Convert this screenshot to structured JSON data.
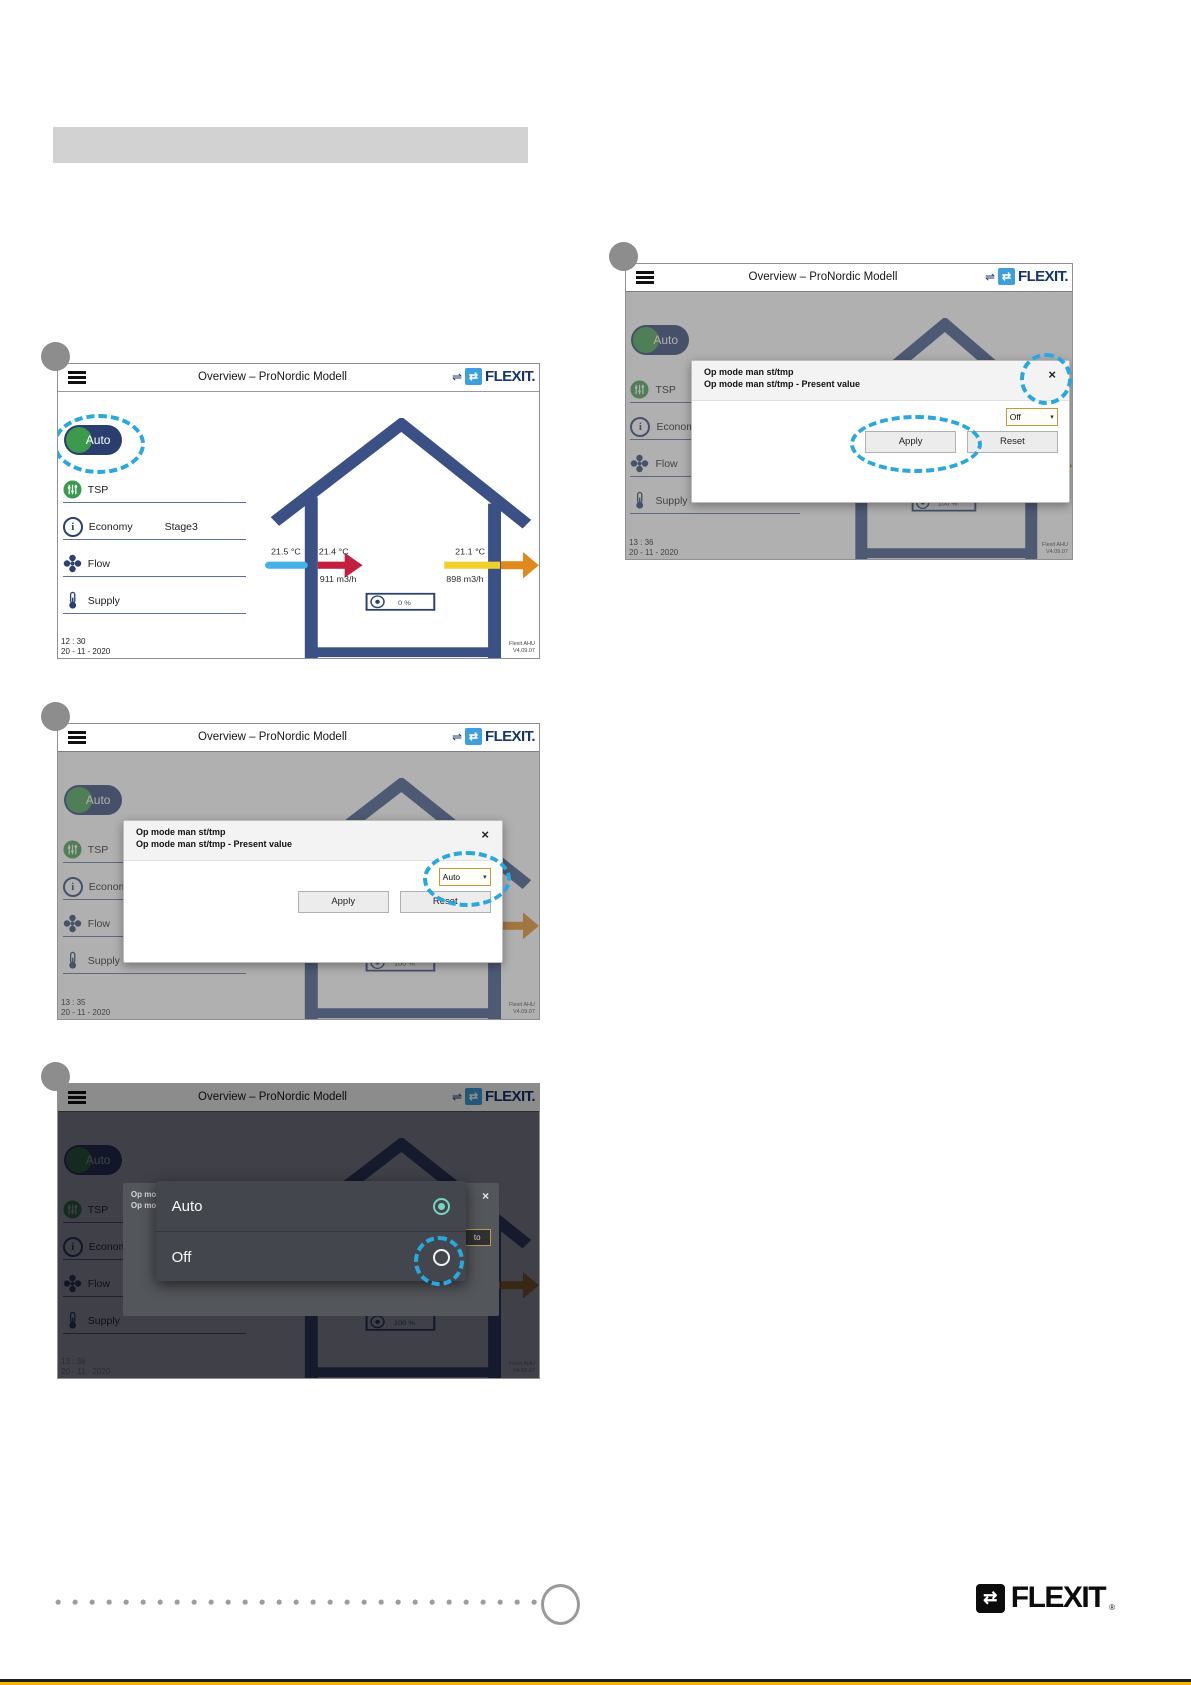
{
  "screen": {
    "title": "Overview – ProNordic Modell",
    "brand": "FLEXIT.",
    "menu": {
      "auto": "Auto",
      "tsp": "TSP",
      "economy": "Economy",
      "economy_value": "Stage3",
      "flow": "Flow",
      "supply": "Supply"
    },
    "house": {
      "temp_outdoor": "21.5 °C",
      "temp_supply": "21.4 °C",
      "temp_extract": "21.1 °C",
      "flow_supply": "911 m3/h",
      "flow_extract": "898 m3/h"
    },
    "version_line1": "Flexit AHU",
    "version_line2": "V4.09.07",
    "dialog": {
      "title1": "Op mode man st/tmp",
      "title2": "Op mode man st/tmp - Present value",
      "apply": "Apply",
      "reset": "Reset"
    },
    "popup": {
      "auto": "Auto",
      "off": "Off"
    },
    "icons": {
      "swap": "⇌",
      "logo_glyph": "⇄",
      "close": "×",
      "caret": "▾",
      "info": "i"
    }
  },
  "panels": [
    {
      "time": "12 : 30",
      "date": "20 - 11 - 2020",
      "fan": "0 %"
    },
    {
      "time": "13 : 35",
      "date": "20 - 11 - 2020",
      "fan": "100 %",
      "dialog_value": "Auto"
    },
    {
      "time": "13 : 36",
      "date": "20 - 11 - 2020",
      "fan": "100 %",
      "dim": {
        "line1": "Op mo",
        "line2": "Op mo",
        "remnant": "to"
      }
    },
    {
      "time": "13 : 36",
      "date": "20 - 11 - 2020",
      "fan": "100 %",
      "dialog_value": "Off"
    }
  ],
  "footer": {
    "brand": "FLEXIT",
    "reg": "®"
  },
  "colors": {
    "navy": "#2d4170",
    "house_blue": "#3b5186",
    "logo_blue": "#3f9fdc",
    "annotation_cyan": "#29a8e0",
    "green": "#3c9a4c",
    "arrow_blue": "#45b1e8",
    "arrow_red": "#c41f3e",
    "arrow_yellow": "#efd02c",
    "arrow_orange": "#e08a1e"
  }
}
